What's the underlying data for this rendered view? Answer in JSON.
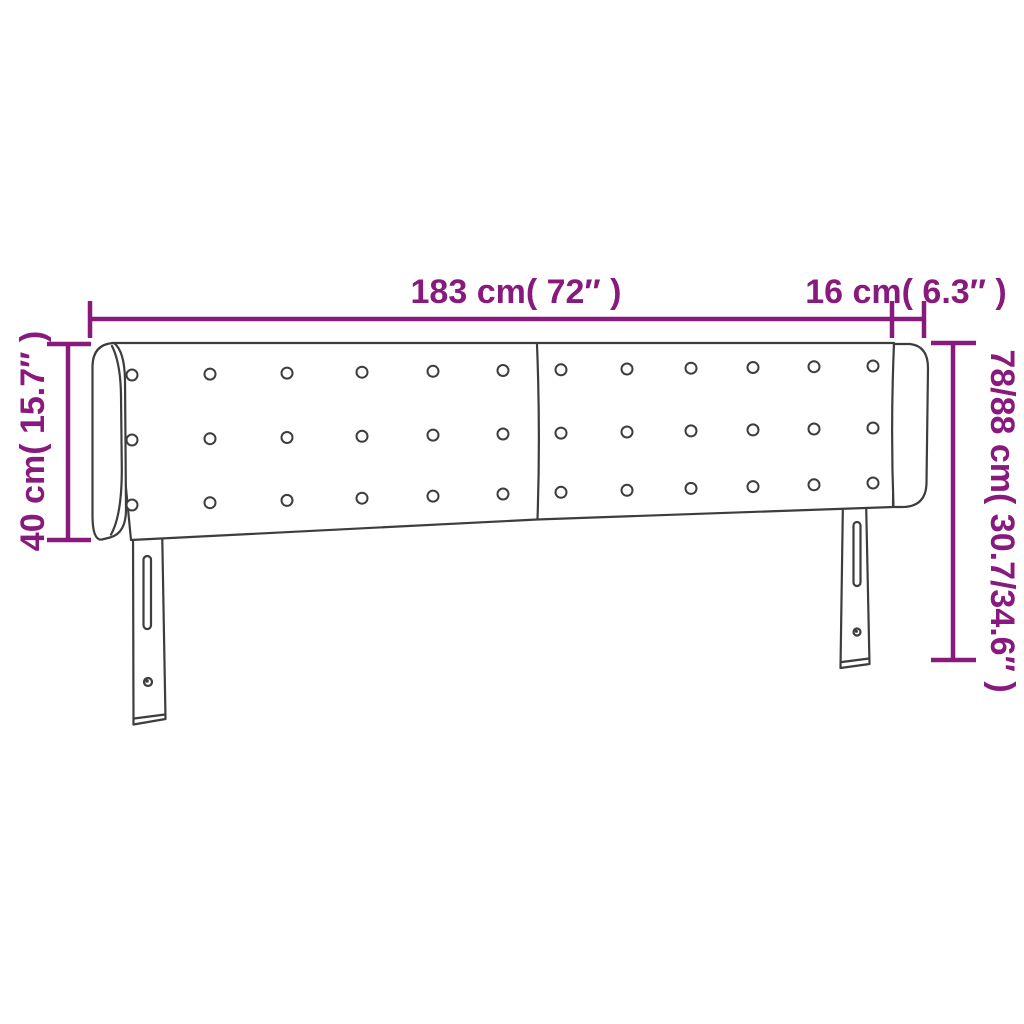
{
  "diagram": {
    "kind": "product-dimension-diagram",
    "subject": "upholstered headboard with side wings, tufted buttons and two adjustable legs",
    "background_color": "#ffffff",
    "accent_color": "#881A7D",
    "drawing_line_color": "#3d3d3d"
  },
  "dimensions": {
    "width": {
      "label": "183 cm( 72″ )",
      "value_cm": "183",
      "value_in": "72″",
      "orientation": "horizontal-top"
    },
    "wing_depth": {
      "label": "16 cm( 6.3″ )",
      "value_cm": "16",
      "value_in": "6.3″",
      "orientation": "horizontal-top-right"
    },
    "headboard_height": {
      "label": "40 cm( 15.7″ )",
      "value_cm": "40",
      "value_in": "15.7″",
      "orientation": "vertical-left"
    },
    "total_height": {
      "label": "78/88 cm( 30.7/34.6″ )",
      "value_cm": "78/88",
      "value_in": "30.7/34.6″",
      "orientation": "vertical-right"
    }
  },
  "headboard": {
    "panels": 2,
    "button_rows": 3,
    "button_columns": 12,
    "legs": 2,
    "leg_features": [
      "adjustment-slot",
      "screw-hole"
    ]
  }
}
